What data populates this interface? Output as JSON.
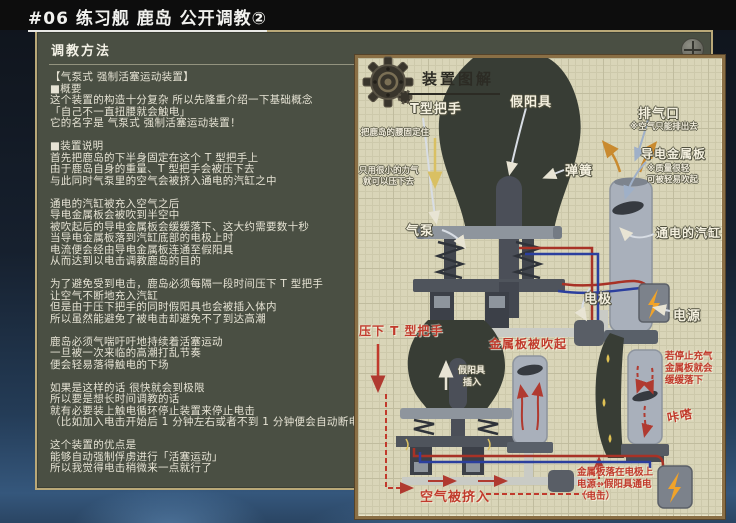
{
  "window": {
    "title": "#06 练习舰 鹿岛 公开调教②"
  },
  "left_panel": {
    "header": "调教方法",
    "lines": [
      "【气泵式 强制活塞运动装置】",
      "■概要",
      "这个装置的构造十分复杂 所以先隆重介绍一下基础概念",
      "「自己不一直扭腰就会触电」",
      "它的名字是 气泵式 强制活塞运动装置！",
      "",
      "■装置说明",
      "首先把鹿岛的下半身固定在这个 T 型把手上",
      "由于鹿岛自身的重量、T 型把手会被压下去",
      "与此同时气泵里的空气会被挤入通电的汽缸之中",
      "",
      "通电的汽缸被充入空气之后",
      "导电金属板会被吹到半空中",
      "被吹起后的导电金属板会缓缓落下、这大约需要数十秒",
      "当导电金属板落到汽缸底部的电极上时",
      "电流便会经由导电金属板连通至假阳具",
      "从而达到以电击调教鹿岛的目的",
      "",
      "为了避免受到电击，鹿岛必须每隔一段时间压下 T 型把手",
      "让空气不断地充入汽缸",
      "但是由于压下把手的同时假阳具也会被插入体内",
      "所以虽然能避免了被电击却避免不了到达高潮",
      "",
      "鹿岛必须气喘吁吁地持续着活塞运动",
      "一旦被一次来临的高潮打乱节奏",
      "便会轻易落得触电的下场",
      "",
      "如果是这样的话 很快就会到极限",
      "所以要是想长时间调教的话",
      "就有必要装上触电循环停止装置来停止电击",
      "（比如加入电击开始后 1 分钟左右或者不到 1 分钟便会自动断电的装置）",
      "",
      "这个装置的优点是",
      "能够自动强制俘虏进行「活塞运动」",
      "所以我觉得电击稍微来一点就行了"
    ]
  },
  "diagram": {
    "title": "装置图解",
    "labels": {
      "t_handle": "T型把手",
      "dildo": "假阳具",
      "exhaust_port": "排气口",
      "exhaust_note": "※空气只能排出去",
      "metal_plate": "导电金属板",
      "plate_note_1": "※质量很轻",
      "plate_note_2": "可被轻易吹起",
      "spring": "弹簧",
      "air_pump": "气泵",
      "cylinder": "通电的汽缸",
      "electrode": "电极",
      "power": "电源",
      "fix_note": "把鹿岛的腰固定住",
      "force_note_1": "只用很小的力气",
      "force_note_2": "就可以压下去",
      "press_handle": "压下 T 型把手",
      "plate_blown": "金属板被吹起",
      "insert_1": "假阳具",
      "insert_2": "插入",
      "air_in": "空气被挤入",
      "stop_note_1": "若停止充气",
      "stop_note_2": "金属板就会",
      "stop_note_3": "缓缓落下",
      "click_sfx": "咔嗒",
      "shock_note_1": "金属板落在电极上",
      "shock_note_2": "电源→假阳具通电",
      "shock_note_3": "（电击）"
    }
  },
  "icons": {
    "gear": "gear-icon",
    "zoom": "plus-zoom-icon",
    "lightning": "lightning-bolt-icon"
  },
  "colors": {
    "accent_red": "#c13a2c",
    "wire_red": "#a83226",
    "wire_blue": "#2b3f9e",
    "lightning": "#f0a32a",
    "panel_olive": "#4a4f43",
    "paper": "#d9d5b8"
  }
}
